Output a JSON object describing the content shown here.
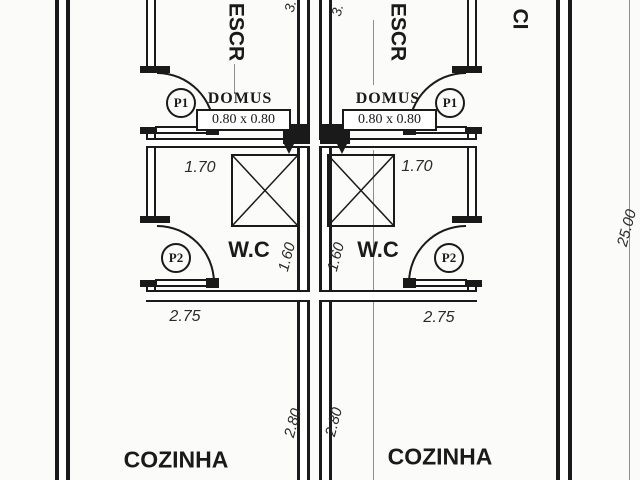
{
  "site": {
    "length_dim": "25.00",
    "circulation_label": "CI"
  },
  "units": [
    {
      "office_label": "ESCR",
      "office_height_dim": "3.",
      "skylight_label": "DOMUS",
      "skylight_size": "0.80 x 0.80",
      "door_1": "P1",
      "door_2": "P2",
      "wc": {
        "label": "W.C",
        "width": "1.70",
        "depth": "1.60",
        "outer_width": "2.75"
      },
      "kitchen": {
        "label": "COZINHA",
        "dim": "2.80"
      }
    },
    {
      "office_label": "ESCR",
      "office_height_dim": "3.",
      "skylight_label": "DOMUS",
      "skylight_size": "0.80 x 0.80",
      "door_1": "P1",
      "door_2": "P2",
      "wc": {
        "label": "W.C",
        "width": "1.70",
        "depth": "1.60",
        "outer_width": "2.75"
      },
      "kitchen": {
        "label": "COZINHA",
        "dim": "2.80"
      }
    }
  ],
  "colors": {
    "line": "#1a1a1a",
    "paper": "#fbfbf9",
    "dim_line": "#8f8f8f"
  }
}
